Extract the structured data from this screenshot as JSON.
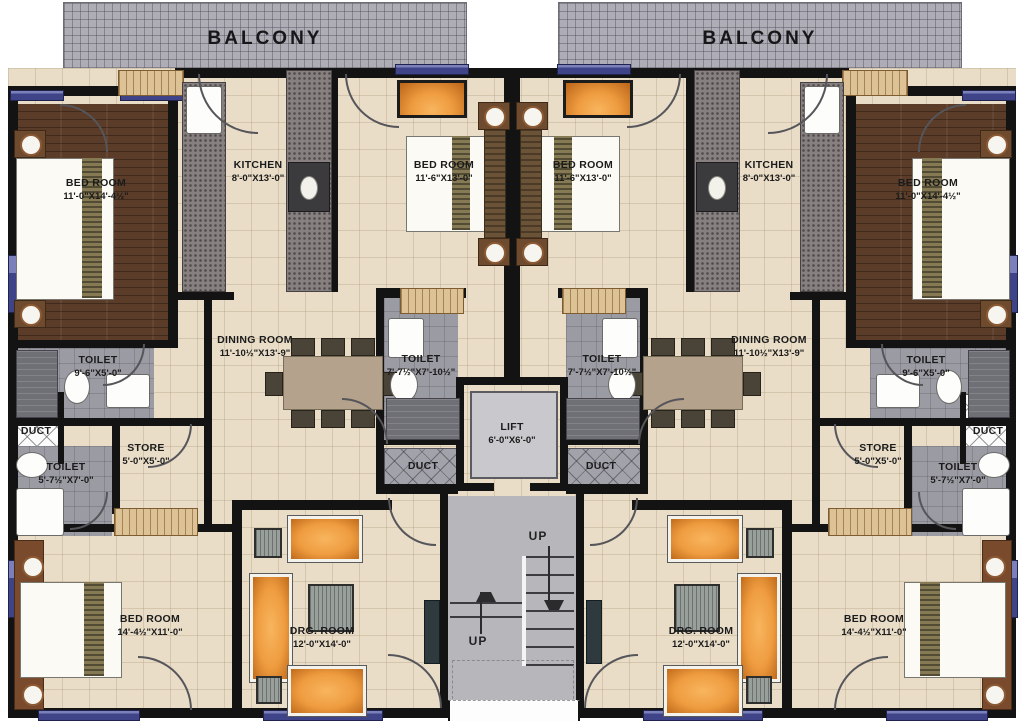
{
  "plan_title": "Residential floor plan - two mirrored apartment units",
  "balconies": [
    {
      "label": "BALCONY"
    },
    {
      "label": "BALCONY"
    }
  ],
  "stairs": {
    "up_top": "UP",
    "up_bottom": "UP"
  },
  "colors": {
    "wall": "#131313",
    "floor_tile": "#e9ddc8",
    "wood_floor": "#5a3c28",
    "toilet_tile": "#9b9ba3",
    "balcony_tile": "#aeacb4",
    "window_accent": "#3f4489",
    "lift_cab": "#c9c9cd",
    "stair_gray": "#b7b7bb",
    "furniture_orange": "#ef9c40",
    "wardrobe_tan": "#dcc294",
    "counter_gray": "#878080"
  },
  "rooms": [
    {
      "id": "bedroom-top-left",
      "name": "BED ROOM",
      "dims": "11'-0\"X14'-4½\"",
      "box": [
        14,
        104,
        156,
        240
      ],
      "surface": "wood",
      "label": [
        96,
        190
      ]
    },
    {
      "id": "kitchen-left",
      "name": "KITCHEN",
      "dims": "8'-0\"X13'-0\"",
      "box": [
        179,
        78,
        148,
        214
      ],
      "surface": "none",
      "label": [
        258,
        172
      ]
    },
    {
      "id": "bedroom-top-center-left",
      "name": "BED ROOM",
      "dims": "11'-6\"X13'-0\"",
      "box": [
        338,
        78,
        166,
        208
      ],
      "surface": "none",
      "label": [
        444,
        172
      ]
    },
    {
      "id": "bedroom-top-center-right",
      "name": "BED ROOM",
      "dims": "11'-6\"X13'-0\"",
      "box": [
        520,
        78,
        166,
        208
      ],
      "surface": "none",
      "label": [
        583,
        172
      ]
    },
    {
      "id": "kitchen-right",
      "name": "KITCHEN",
      "dims": "8'-0\"X13'-0\"",
      "box": [
        697,
        78,
        148,
        214
      ],
      "surface": "none",
      "label": [
        769,
        172
      ]
    },
    {
      "id": "bedroom-top-right",
      "name": "BED ROOM",
      "dims": "11'-0\"X14'-4½\"",
      "box": [
        854,
        104,
        156,
        240
      ],
      "surface": "wood",
      "label": [
        928,
        190
      ]
    },
    {
      "id": "toilet-left-upper",
      "name": "TOILET",
      "dims": "9'-6\"X5'-0\"",
      "box": [
        14,
        348,
        140,
        70
      ],
      "surface": "gray",
      "label": [
        98,
        367
      ]
    },
    {
      "id": "duct-left",
      "name": "DUCT",
      "dims": "",
      "box": [
        12,
        394,
        48,
        68
      ],
      "surface": "whitehatch",
      "label": [
        36,
        432
      ]
    },
    {
      "id": "toilet-left-lower",
      "name": "TOILET",
      "dims": "5'-7½\"X7'-0\"",
      "box": [
        14,
        446,
        98,
        90
      ],
      "surface": "gray",
      "label": [
        66,
        474
      ]
    },
    {
      "id": "store-left",
      "name": "STORE",
      "dims": "5'-0\"X5'-0\"",
      "box": [
        114,
        420,
        90,
        86
      ],
      "surface": "none",
      "label": [
        146,
        455
      ]
    },
    {
      "id": "dining-left",
      "name": "DINING ROOM",
      "dims": "11'-10½\"X13'-9\"",
      "box": [
        212,
        294,
        164,
        206
      ],
      "surface": "none",
      "label": [
        255,
        347
      ]
    },
    {
      "id": "toilet-center-left",
      "name": "TOILET",
      "dims": "7'-7½\"X7'-10½\"",
      "box": [
        384,
        296,
        74,
        146
      ],
      "surface": "gray",
      "label": [
        421,
        366
      ]
    },
    {
      "id": "duct-center-left",
      "name": "DUCT",
      "dims": "",
      "box": [
        384,
        448,
        74,
        40
      ],
      "surface": "grayhatch",
      "label": [
        423,
        467
      ]
    },
    {
      "id": "lift",
      "name": "LIFT",
      "dims": "6'-0\"X6'-0\"",
      "box": [
        458,
        379,
        108,
        112
      ],
      "surface": "none",
      "label": [
        512,
        434
      ]
    },
    {
      "id": "toilet-center-right",
      "name": "TOILET",
      "dims": "7'-7½\"X7'-10½\"",
      "box": [
        566,
        296,
        74,
        146
      ],
      "surface": "gray",
      "label": [
        602,
        366
      ]
    },
    {
      "id": "duct-center-right",
      "name": "DUCT",
      "dims": "",
      "box": [
        566,
        448,
        74,
        40
      ],
      "surface": "grayhatch",
      "label": [
        601,
        467
      ]
    },
    {
      "id": "dining-right",
      "name": "DINING ROOM",
      "dims": "11'-10½\"X13'-9\"",
      "box": [
        648,
        294,
        164,
        206
      ],
      "surface": "none",
      "label": [
        769,
        347
      ]
    },
    {
      "id": "toilet-right-upper",
      "name": "TOILET",
      "dims": "9'-6\"X5'-0\"",
      "box": [
        870,
        348,
        140,
        70
      ],
      "surface": "gray",
      "label": [
        926,
        367
      ]
    },
    {
      "id": "duct-right",
      "name": "DUCT",
      "dims": "",
      "box": [
        964,
        394,
        48,
        68
      ],
      "surface": "whitehatch",
      "label": [
        988,
        432
      ]
    },
    {
      "id": "toilet-right-lower",
      "name": "TOILET",
      "dims": "5'-7½\"X7'-0\"",
      "box": [
        912,
        446,
        98,
        90
      ],
      "surface": "gray",
      "label": [
        958,
        474
      ]
    },
    {
      "id": "store-right",
      "name": "STORE",
      "dims": "5'-0\"X5'-0\"",
      "box": [
        820,
        420,
        90,
        86
      ],
      "surface": "none",
      "label": [
        878,
        455
      ]
    },
    {
      "id": "bedroom-bottom-left",
      "name": "BED ROOM",
      "dims": "14'-4½\"X11'-0\"",
      "box": [
        14,
        532,
        218,
        176
      ],
      "surface": "none",
      "label": [
        150,
        626
      ]
    },
    {
      "id": "drawing-room-left",
      "name": "DRG. ROOM",
      "dims": "12'-0\"X14'-0\"",
      "box": [
        242,
        510,
        198,
        198
      ],
      "surface": "none",
      "label": [
        322,
        638
      ]
    },
    {
      "id": "drawing-room-right",
      "name": "DRG. ROOM",
      "dims": "12'-0\"X14'-0\"",
      "box": [
        584,
        510,
        198,
        198
      ],
      "surface": "none",
      "label": [
        701,
        638
      ]
    },
    {
      "id": "bedroom-bottom-right",
      "name": "BED ROOM",
      "dims": "14'-4½\"X11'-0\"",
      "box": [
        792,
        532,
        218,
        176
      ],
      "surface": "none",
      "label": [
        874,
        626
      ]
    }
  ]
}
